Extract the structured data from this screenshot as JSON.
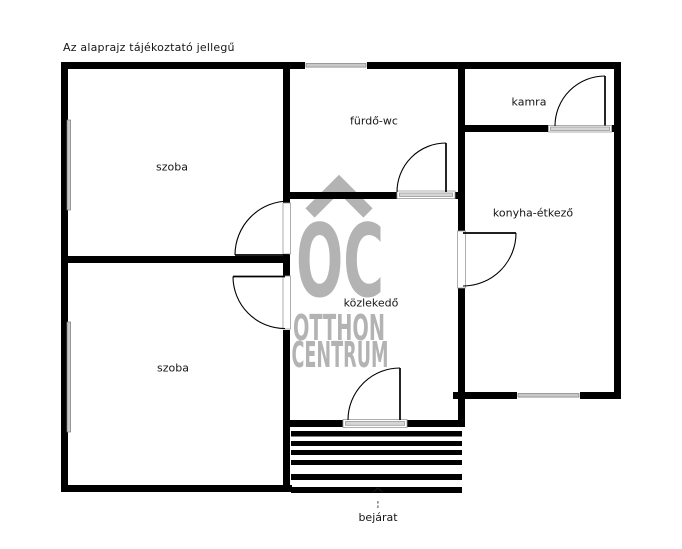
{
  "plan": {
    "disclaimer": "Az alaprajz tájékoztató jellegű",
    "rooms": {
      "szoba_top": {
        "label": "szoba"
      },
      "furdo_wc": {
        "label": "fürdő-wc"
      },
      "kamra": {
        "label": "kamra"
      },
      "konyha_etkezo": {
        "label": "konyha-étkező"
      },
      "kozlekedo": {
        "label": "közlekedő"
      },
      "szoba_bottom": {
        "label": "szoba"
      }
    },
    "entrance": {
      "label": "bejárat",
      "arrow_glyph": "^"
    }
  },
  "watermark": {
    "monogram": "OC",
    "line1": "OTTHON",
    "line2": "CENTRUM",
    "color": "#b3b3b3"
  },
  "colors": {
    "wall": "#000000",
    "window_fill": "#c9c9c9",
    "text": "#161616",
    "background": "#ffffff"
  }
}
